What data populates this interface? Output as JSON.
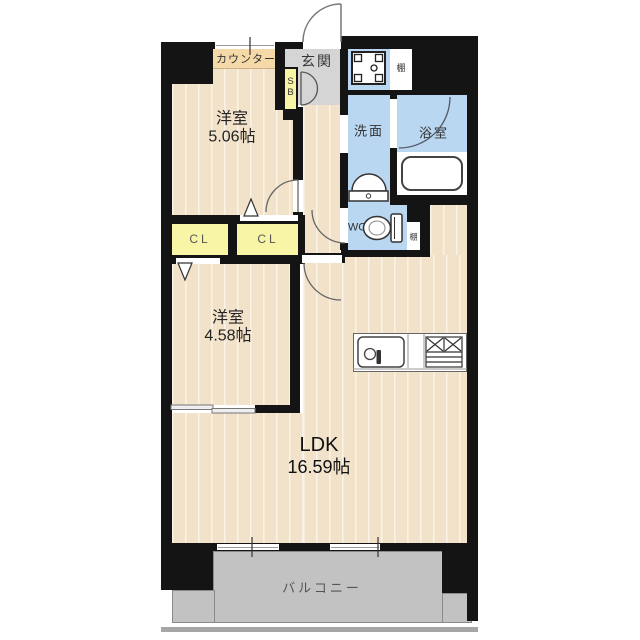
{
  "plan_type": "floor-plan",
  "rooms": {
    "bedroom1": {
      "name": "洋室",
      "size": "5.06帖"
    },
    "bedroom2": {
      "name": "洋室",
      "size": "4.58帖"
    },
    "ldk": {
      "name": "LDK",
      "size": "16.59帖"
    },
    "entrance": {
      "label": "玄関"
    },
    "washroom": {
      "label": "洗面"
    },
    "bathroom": {
      "label": "浴室"
    },
    "wc": {
      "label": "WC"
    },
    "balcony": {
      "label": "バルコニー"
    },
    "counter": {
      "label": "カウンター"
    },
    "closet_left": {
      "label": "CL"
    },
    "closet_right": {
      "label": "CL"
    },
    "shoe_box": {
      "label": "S\nB"
    },
    "shelf_upper": {
      "label": "棚"
    },
    "shelf_wc": {
      "label": "棚"
    }
  },
  "colors": {
    "wood_floor": "#f2e2c9",
    "wet_area_blue": "#b9d7f1",
    "closet_yellow": "#f8f6a6",
    "entrance_gray": "#d5d5d5",
    "balcony_gray": "#c2c2c2",
    "counter_tan": "#f5d9a8",
    "wall_black": "#141414"
  }
}
